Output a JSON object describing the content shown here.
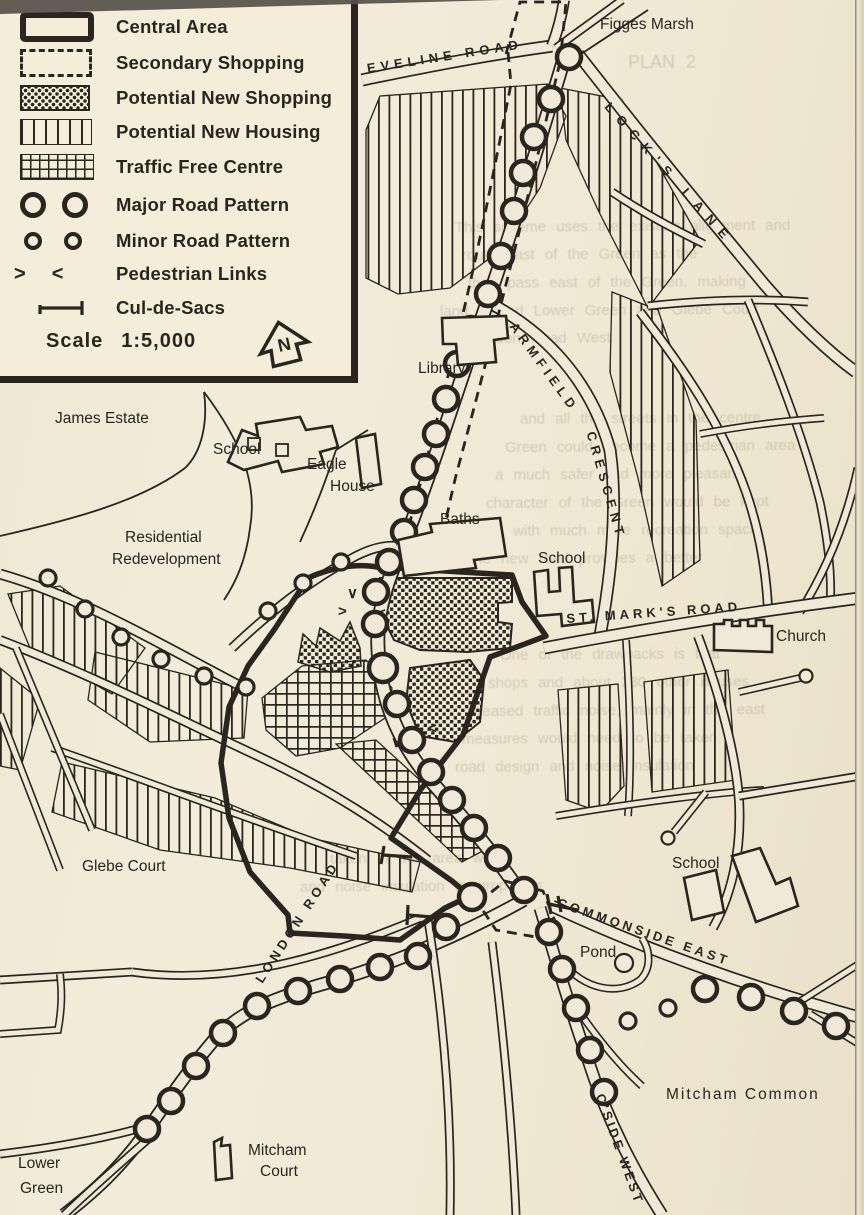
{
  "colors": {
    "ink": "#2b251f",
    "paper": "#f1e9d7"
  },
  "legend": {
    "items": [
      {
        "label": "Central Area",
        "swatch": "central"
      },
      {
        "label": "Secondary Shopping",
        "swatch": "dashed"
      },
      {
        "label": "Potential New Shopping",
        "swatch": "dots"
      },
      {
        "label": "Potential New Housing",
        "swatch": "vlines"
      },
      {
        "label": "Traffic Free Centre",
        "swatch": "grid"
      },
      {
        "label": "Major Road Pattern",
        "swatch": "major-circles"
      },
      {
        "label": "Minor Road Pattern",
        "swatch": "minor-circles"
      },
      {
        "label": "Pedestrian Links",
        "swatch": "chevrons",
        "glyph_left": ">",
        "glyph_right": "<"
      },
      {
        "label": "Cul-de-Sacs",
        "swatch": "culdesac"
      }
    ],
    "scale_label": "Scale",
    "scale_value": "1:5,000",
    "north_letter": "N"
  },
  "map": {
    "labels": {
      "figges_marsh": "Figges Marsh",
      "eveline_road": "EVELINE ROAD",
      "locks_lane": "LOCK'S LANE",
      "armfield": "ARMFIELD",
      "crescent": "CRESCENT",
      "library": "Library",
      "james_estate": "James Estate",
      "school_nw": "School",
      "eagle_line1": "Eagle",
      "eagle_line2": "House",
      "residential_line1": "Residential",
      "residential_line2": "Redevelopment",
      "baths": "Baths",
      "school_central": "School",
      "st_marks_road": "ST. MARK'S ROAD",
      "church": "Church",
      "glebe_court": "Glebe Court",
      "london_road": "LONDON ROAD",
      "commonside_east": "COMMONSIDE EAST",
      "pond": "Pond",
      "school_se": "School",
      "mitcham_common": "Mitcham Common",
      "mitcham_court_line1": "Mitcham",
      "mitcham_court_line2": "Court",
      "lower_green_line1": "Lower",
      "lower_green_line2": "Green",
      "cside_west": "C'SIDE WEST"
    },
    "symbols": {
      "ped_right": ">",
      "ped_left": "<",
      "ped_down": "∨"
    }
  },
  "ghost_text": {
    "lines": [
      {
        "x": 628,
        "y": 52,
        "text": "PLAN 2",
        "size": 18
      },
      {
        "x": 455,
        "y": 218,
        "text": "This scheme uses the existing alignment and"
      },
      {
        "x": 462,
        "y": 246,
        "text": "route east of the Green as the"
      },
      {
        "x": 468,
        "y": 274,
        "text": "then pass east of the Green, making"
      },
      {
        "x": 440,
        "y": 302,
        "text": "land behind Lower Green and Glebe Court"
      },
      {
        "x": 448,
        "y": 330,
        "text": "to London Road West"
      },
      {
        "x": 520,
        "y": 410,
        "text": "and all the streets in the centre"
      },
      {
        "x": 505,
        "y": 438,
        "text": "Green could become a pedestrian area"
      },
      {
        "x": 495,
        "y": 466,
        "text": "a much safer and more pleasant"
      },
      {
        "x": 486,
        "y": 494,
        "text": "character of the Green would be kept"
      },
      {
        "x": 478,
        "y": 522,
        "text": "and with much more recreation space"
      },
      {
        "x": 470,
        "y": 550,
        "text": "the new road provides a better"
      },
      {
        "x": 500,
        "y": 646,
        "text": "One of the drawbacks is that"
      },
      {
        "x": 488,
        "y": 674,
        "text": "shops and about 230 other houses"
      },
      {
        "x": 470,
        "y": 702,
        "text": "creased traffic noise, mainly in the east"
      },
      {
        "x": 462,
        "y": 730,
        "text": "measures would need to be taken"
      },
      {
        "x": 455,
        "y": 758,
        "text": "road design and noise insulation"
      },
      {
        "x": 330,
        "y": 850,
        "text": "taken in this area when"
      },
      {
        "x": 300,
        "y": 878,
        "text": "and noise insulation to proposals"
      }
    ]
  }
}
